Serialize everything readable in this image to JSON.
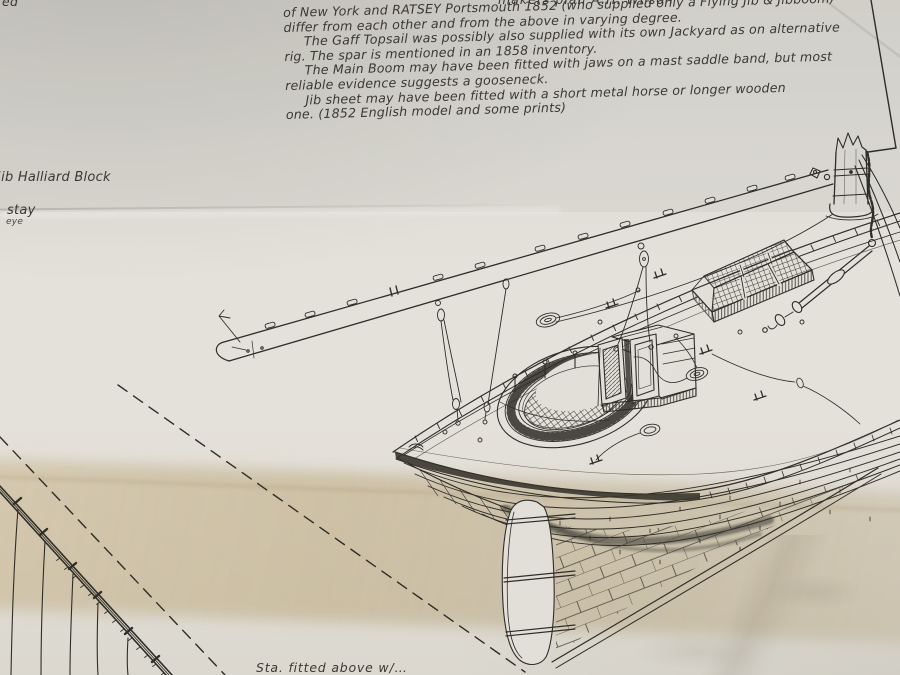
{
  "notes": {
    "clipped_top_line": "makers plan A.H. Wilson",
    "lines": [
      "of New York and RATSEY Portsmouth 1852 (who supplied only a Flying Jib & Jibboom)",
      "differ from each other and from the above in varying degree.",
      "The Gaff Topsail was possibly also supplied with its own Jackyard as on alternative",
      "rig. The spar is mentioned in an 1858 inventory.",
      "The Main Boom may have been fitted with jaws on a mast saddle band, but most",
      "reliable evidence suggests a gooseneck.",
      "Jib sheet may have been fitted with a short metal horse or longer wooden",
      "one. (1852 English model and some prints)"
    ]
  },
  "labels": {
    "top_left_fragment": "ed",
    "jib_halliard_block": "Jib Halliard Block",
    "stay": "stay",
    "eye": "eye",
    "bottom_partial": "Sta. fitted above w/…"
  },
  "drawing": {
    "components": [
      "main boom",
      "mast stump",
      "shrouds",
      "backstay tackle",
      "cockpit with grating",
      "companionway hatch",
      "skylight gratings",
      "rope coils",
      "deck cleats",
      "bulwark rail",
      "hull planking",
      "copper sheathing",
      "rudder",
      "gaff spar with sail lacing",
      "dashed construction lines"
    ]
  },
  "colors": {
    "paper": "#e2dfd8",
    "stain": "#cdbb96",
    "ink": "#2f2d28"
  }
}
